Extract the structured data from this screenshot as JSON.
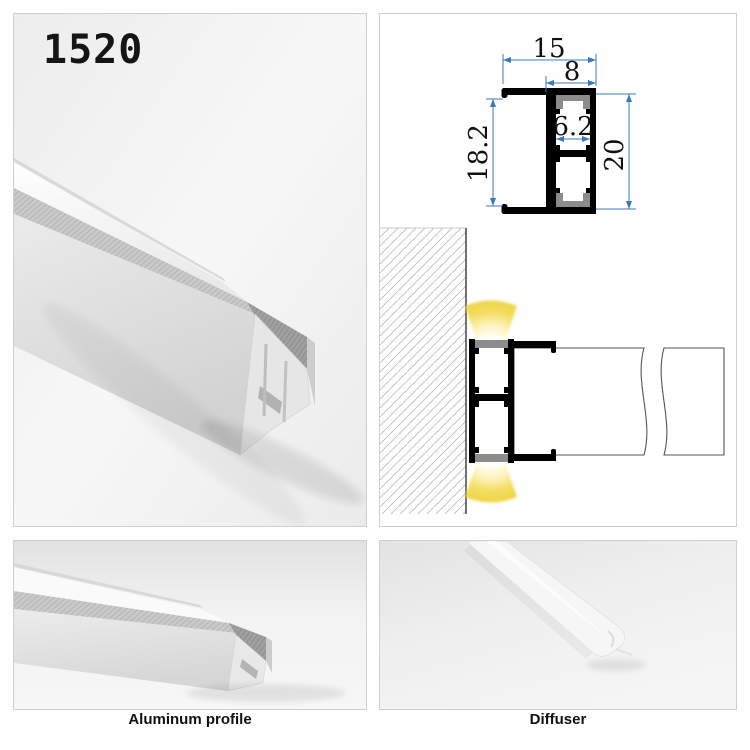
{
  "product": {
    "model": "1520"
  },
  "drawing": {
    "dimensions": {
      "total_width": "15",
      "channel_width": "8",
      "inner_width": "6.2",
      "inner_height": "18.2",
      "total_height": "20"
    },
    "colors": {
      "dimension_line": "#3a78c2",
      "profile_body": "#000000",
      "diffuser_gray": "#8c8c8c",
      "glow_yellow": "#f0d84e",
      "hatch_gray": "#bdbdbd"
    }
  },
  "captions": {
    "bottom_left": "Aluminum profile",
    "bottom_right": "Diffuser"
  }
}
